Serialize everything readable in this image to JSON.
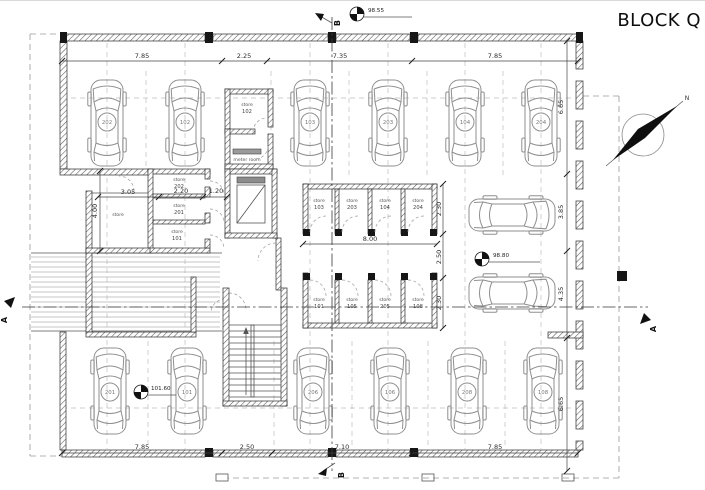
{
  "title": "BLOCK Q",
  "north": {
    "label": "N"
  },
  "drawing": {
    "stores": {
      "word": "store",
      "left_block": [
        "202",
        "201",
        "101"
      ],
      "left_room_label": "store",
      "top_store": "102",
      "meter_room": "meter room",
      "row_upper": [
        "103",
        "203",
        "104",
        "204"
      ],
      "row_lower": [
        "101",
        "105",
        "205",
        "108"
      ]
    },
    "cars": {
      "top": [
        "202",
        "102",
        "103",
        "203",
        "104",
        "204"
      ],
      "bottom": [
        "201",
        "101",
        "206",
        "106",
        "208",
        "108"
      ]
    },
    "levels": {
      "upper": "98.55",
      "middle": "98.80",
      "lower": "101.60"
    },
    "dims": {
      "top": [
        "7.85",
        "2.25",
        "7.35",
        "7.85"
      ],
      "bottom": [
        "7.85",
        "2.50",
        "7.10",
        "7.85"
      ],
      "right": [
        "6.65",
        "3.85",
        "4.35",
        "6.65"
      ],
      "left_v": "4.00",
      "left_h": [
        "3.05",
        "2.20",
        "1.20"
      ],
      "row_width": "8.00",
      "row_h_upper": "2.30",
      "aisle": "2.50",
      "row_h_lower": "2.30"
    },
    "sections": {
      "a": "A",
      "b": "B"
    }
  }
}
